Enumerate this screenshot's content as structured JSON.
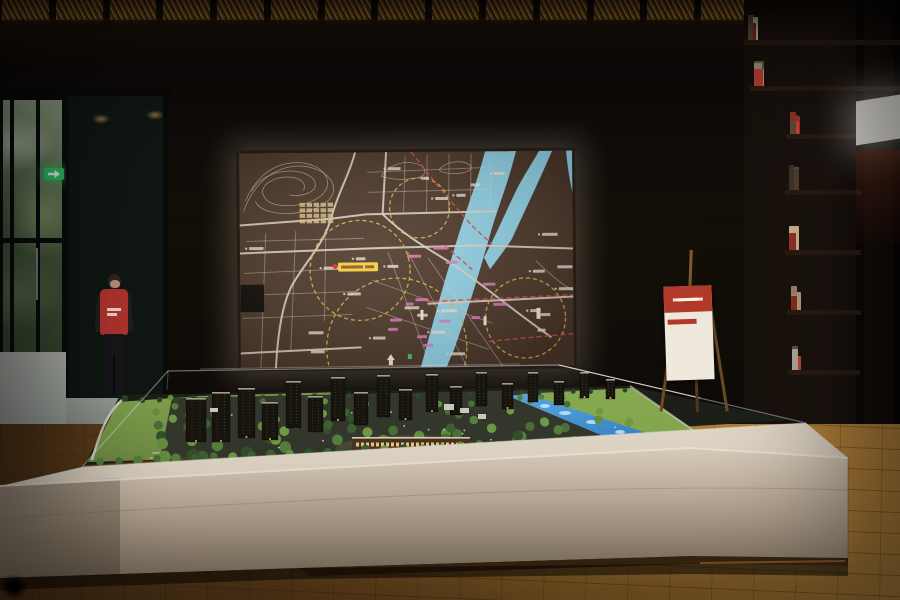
{
  "meta": {
    "caption": "Real-estate sales gallery: illuminated city-location map screen above an architectural scale model in a glass case on a cream display table; lattice screen and glass doors with garden at left, attendant in red vest, red info sign on wooden easel, bookshelf wall and glowing panel at right, amber woven ceiling panels, oak floor.",
    "legible_text": "none — all map, vest and sign text is below legibility at source resolution"
  },
  "colors": {
    "ceiling_amber": "#c08a3e",
    "ceiling_amber_dark": "#6e4a1c",
    "map_bg": "#4a3629",
    "map_road": "#ddd4c6",
    "river": "#8fd2e8",
    "circle_yellow": "#d8b84a",
    "route_red": "#d84848",
    "label_white": "#ece4d6",
    "label_pink": "#e078c0",
    "project_yellow": "#f2d143",
    "exit_green": "#2ec064",
    "vest_red": "#b23530",
    "glow_panel": "#fbf8f2",
    "sign_red": "#b23a2a",
    "sign_body": "#efe8dc",
    "sign_tan": "#c9a684",
    "sign_row_red": "#b34435",
    "lawn": "#7fa04e",
    "lawn_dark": "#5d7f3a",
    "canal": "#3f93d6",
    "tower_dark": "#18150f",
    "lit_window": "#f4cf8a",
    "table_cream": "#dccfbe"
  },
  "ceiling": {
    "panel_count": 14
  },
  "map_screen": {
    "circles": [
      [
        120,
        118,
        50
      ],
      [
        180,
        56,
        30
      ],
      [
        285,
        167,
        40
      ],
      [
        156,
        196,
        70
      ]
    ],
    "red_routes": [
      "M172,0 L200,36 L232,74 L252,93",
      "M186,150 L333,144",
      "M248,190 L333,183",
      "M205,94 L232,118"
    ],
    "white_label_count": 26,
    "pink_label_count": 13,
    "building_cluster": {
      "x": 60,
      "y": 50,
      "rows": 4,
      "cols": 5
    },
    "project_label": {
      "x": 98,
      "y": 110,
      "w": 40,
      "h": 9
    }
  },
  "bookshelf": {
    "palette": [
      "#d8cdb8",
      "#a03828",
      "#c8b088",
      "#5a4a38",
      "#e0d8c8",
      "#8a6a4a",
      "#b8b0a0",
      "#c24438"
    ],
    "shelves": [
      {
        "x": 748,
        "y": 10,
        "w": 146,
        "books": 11
      },
      {
        "x": 754,
        "y": 56,
        "w": 140,
        "books": 10
      },
      {
        "x": 790,
        "y": 104,
        "w": 66,
        "books": 6
      },
      {
        "x": 789,
        "y": 160,
        "w": 67,
        "books": 6
      },
      {
        "x": 789,
        "y": 220,
        "w": 66,
        "books": 5
      },
      {
        "x": 791,
        "y": 280,
        "w": 64,
        "books": 5
      },
      {
        "x": 792,
        "y": 340,
        "w": 62,
        "books": 5
      }
    ]
  },
  "sign": {
    "header_lines": 2,
    "left_rows": 7,
    "right_rows": 7
  },
  "person": {
    "vest_text_lines": 2
  },
  "model": {
    "tree_count": 85,
    "hedge_count": 32,
    "back_row_count": 30,
    "light_dot_count": 14,
    "towers": [
      [
        186,
        48,
        20,
        44
      ],
      [
        212,
        42,
        18,
        50
      ],
      [
        238,
        38,
        17,
        50
      ],
      [
        262,
        52,
        16,
        38
      ],
      [
        286,
        31,
        15,
        47
      ],
      [
        308,
        46,
        15,
        36
      ],
      [
        331,
        27,
        14,
        44
      ],
      [
        354,
        42,
        14,
        33
      ],
      [
        377,
        25,
        13,
        42
      ],
      [
        399,
        39,
        13,
        31
      ],
      [
        426,
        24,
        12,
        38
      ],
      [
        450,
        36,
        12,
        29
      ],
      [
        476,
        22,
        11,
        34
      ],
      [
        502,
        33,
        11,
        26
      ],
      [
        528,
        22,
        10,
        30
      ],
      [
        554,
        31,
        10,
        24
      ],
      [
        580,
        22,
        9,
        26
      ],
      [
        606,
        29,
        9,
        20
      ]
    ]
  }
}
